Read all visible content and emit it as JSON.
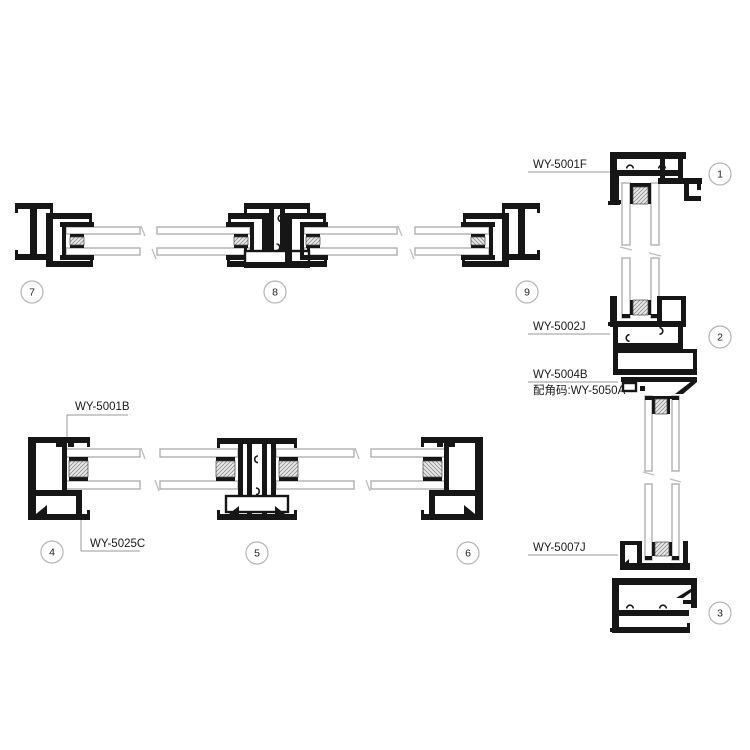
{
  "diagram": {
    "kind": "aluminum-window-profile-cross-sections",
    "labels": {
      "wy5001f": "WY-5001F",
      "wy5002j": "WY-5002J",
      "wy5004b": "WY-5004B",
      "wy5050a": "配角码:WY-5050A",
      "wy5007j": "WY-5007J",
      "wy5001b": "WY-5001B",
      "wy5025c": "WY-5025C"
    },
    "balloons": {
      "b1": "1",
      "b2": "2",
      "b3": "3",
      "b4": "4",
      "b5": "5",
      "b6": "6",
      "b7": "7",
      "b8": "8",
      "b9": "9"
    },
    "colors": {
      "profile": "#161616",
      "glass_outline": "#b0b0b0",
      "leader": "#999999",
      "balloon_outline": "#b5b5b5",
      "text": "#1a1a1a",
      "background": "#ffffff"
    }
  }
}
